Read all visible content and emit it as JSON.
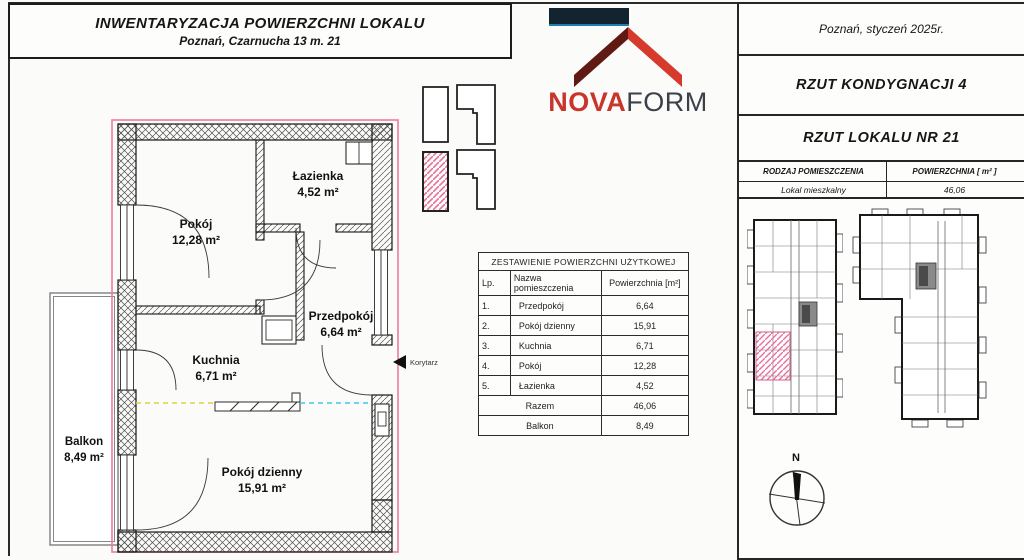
{
  "title_block": {
    "line1": "INWENTARYZACJA POWIERZCHNI LOKALU",
    "line2": "Poznań, Czarnucha 13 m. 21"
  },
  "logo": {
    "nova": "NOVA",
    "form": "FORM"
  },
  "right_panel": {
    "date": "Poznań, styczeń 2025r.",
    "floor_title": "RZUT KONDYGNACJI 4",
    "unit_title": "RZUT LOKALU NR 21",
    "type_table": {
      "col1": "RODZAJ POMIESZCZENIA",
      "col2": "POWIERZCHNIA [ m² ]",
      "row_type": "Lokal mieszkalny",
      "row_area": "46,06"
    },
    "compass_label": "N"
  },
  "area_table": {
    "title": "ZESTAWIENIE POWIERZCHNI UŻYTKOWEJ",
    "headers": {
      "lp": "Lp.",
      "name": "Nazwa pomieszczenia",
      "area": "Powierzchnia [m²]"
    },
    "rows": [
      {
        "lp": "1.",
        "name": "Przedpokój",
        "area": "6,64"
      },
      {
        "lp": "2.",
        "name": "Pokój dzienny",
        "area": "15,91"
      },
      {
        "lp": "3.",
        "name": "Kuchnia",
        "area": "6,71"
      },
      {
        "lp": "4.",
        "name": "Pokój",
        "area": "12,28"
      },
      {
        "lp": "5.",
        "name": "Łazienka",
        "area": "4,52"
      }
    ],
    "total": {
      "label": "Razem",
      "value": "46,06"
    },
    "balcony": {
      "label": "Balkon",
      "value": "8,49"
    }
  },
  "plan": {
    "rooms": [
      {
        "name": "Pokój",
        "area": "12,28 m²"
      },
      {
        "name": "Łazienka",
        "area": "4,52 m²"
      },
      {
        "name": "Przedpokój",
        "area": "6,64 m²"
      },
      {
        "name": "Kuchnia",
        "area": "6,71 m²"
      },
      {
        "name": "Pokój dzienny",
        "area": "15,91 m²"
      },
      {
        "name": "Balkon",
        "area": "8,49 m²"
      }
    ],
    "corridor_label": "Korytarz"
  },
  "colors": {
    "brand_red": "#c9352a",
    "brand_dark": "#3b4049",
    "logo_navy_bar": "#13232f",
    "unit_outline_pink": "#ef7ba3",
    "highlight_hatch_pink": "#e8719c",
    "dash_yellow": "#ddd23e",
    "dash_cyan": "#45c6e8",
    "line_black": "#1d1d1d"
  }
}
